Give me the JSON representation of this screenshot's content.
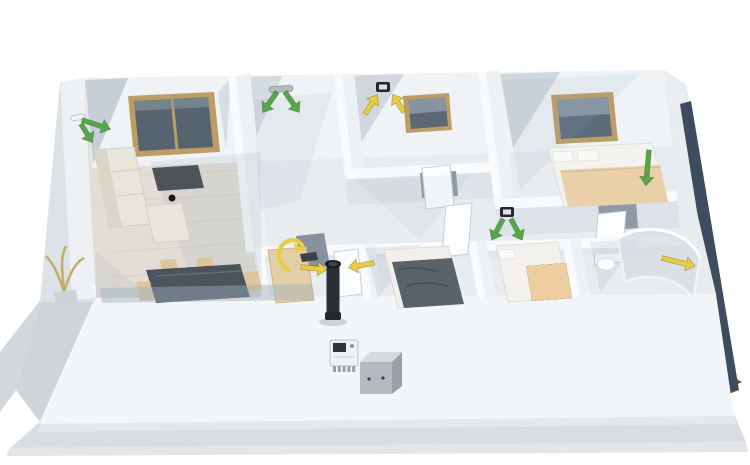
{
  "alt_text": "Isometric 3D cutaway floor plan of a single-storey house with a ventilation system: green supply-air arrows in living room, hallway and bedrooms, yellow extract-air arrows in bathroom, kitchen and shower room, a black kitchen extract duct, a wall-mounted controller and an outdoor unit in front of the facade",
  "palette": {
    "supply_air": "#56a748",
    "extract_air": "#e8ce3c",
    "wall_white": "#f4f6f8",
    "wall_shadow": "#aab6c2",
    "floor": "#e9ecef",
    "wood_floor": "#e3ded5",
    "ground": "#d9dde1",
    "window_frame": "#bd9d66",
    "glass_dark": "#57646f",
    "roof_edge_navy": "#3e4c5f",
    "duct_black": "#24282d",
    "bed_blanket_beige": "#ead0a9",
    "bed_blanket_gray": "#596169"
  },
  "scene": {
    "rooms": [
      {
        "name": "living-room"
      },
      {
        "name": "hallway"
      },
      {
        "name": "bathroom"
      },
      {
        "name": "bedroom"
      },
      {
        "name": "kitchen"
      },
      {
        "name": "bedroom-2"
      },
      {
        "name": "bedroom-3"
      },
      {
        "name": "shower-room"
      }
    ],
    "markers": [
      {
        "name": "living-supply-valve",
        "kind": "wallvalve",
        "type": "supply",
        "x": 78,
        "y": 118,
        "angle": 80
      },
      {
        "name": "living-supply-arrow-1",
        "kind": "arrow",
        "type": "supply",
        "x": 82,
        "y": 120,
        "angle": 18,
        "len": 30
      },
      {
        "name": "living-supply-arrow-2",
        "kind": "arrow",
        "type": "supply",
        "x": 81,
        "y": 124,
        "angle": 58,
        "len": 22
      },
      {
        "name": "hallway-ceiling-diffuser",
        "kind": "bar",
        "type": "supply",
        "x": 281,
        "y": 89,
        "w": 24
      },
      {
        "name": "hallway-supply-arrow-left",
        "kind": "arrow",
        "type": "supply",
        "x": 277,
        "y": 92,
        "angle": 125,
        "len": 25
      },
      {
        "name": "hallway-supply-arrow-right",
        "kind": "arrow",
        "type": "supply",
        "x": 285,
        "y": 92,
        "angle": 55,
        "len": 25
      },
      {
        "name": "bathroom-extract-valve",
        "kind": "valve",
        "type": "extract",
        "x": 383,
        "y": 87
      },
      {
        "name": "bathroom-extract-arrow-left",
        "kind": "arrow",
        "type": "extract",
        "x": 365,
        "y": 114,
        "angle": -57,
        "len": 23
      },
      {
        "name": "bathroom-extract-arrow-right",
        "kind": "arrow",
        "type": "extract",
        "x": 404,
        "y": 112,
        "angle": -123,
        "len": 21
      },
      {
        "name": "bedroom2-ceiling-valve",
        "kind": "valve",
        "type": "supply",
        "x": 507,
        "y": 212
      },
      {
        "name": "bedroom2-supply-arrow-left",
        "kind": "arrow",
        "type": "supply",
        "x": 503,
        "y": 219,
        "angle": 118,
        "len": 24
      },
      {
        "name": "bedroom2-supply-arrow-right",
        "kind": "arrow",
        "type": "supply",
        "x": 511,
        "y": 219,
        "angle": 62,
        "len": 24
      },
      {
        "name": "bedroom-supply-arrow",
        "kind": "arrow",
        "type": "supply",
        "x": 649,
        "y": 150,
        "angle": 95,
        "len": 36
      },
      {
        "name": "kitchen-extract-duct",
        "kind": "duct",
        "type": "extract",
        "x": 333,
        "y": 264,
        "h": 54
      },
      {
        "name": "kitchen-extract-arrow-left",
        "kind": "arrow",
        "type": "extract",
        "x": 301,
        "y": 267,
        "angle": 6,
        "len": 26
      },
      {
        "name": "kitchen-extract-arrow-right",
        "kind": "arrow",
        "type": "extract",
        "x": 374,
        "y": 263,
        "angle": 170,
        "len": 26
      },
      {
        "name": "kitchen-extract-swirl",
        "kind": "swirl",
        "type": "extract",
        "x": 290,
        "y": 252
      },
      {
        "name": "shower-extract-arrow",
        "kind": "arrow",
        "type": "extract",
        "x": 662,
        "y": 258,
        "angle": 14,
        "len": 34
      }
    ],
    "devices": [
      {
        "name": "wall-controller",
        "kind": "controller",
        "x": 330,
        "y": 340
      },
      {
        "name": "outdoor-unit",
        "kind": "box",
        "x": 360,
        "y": 352
      }
    ]
  }
}
